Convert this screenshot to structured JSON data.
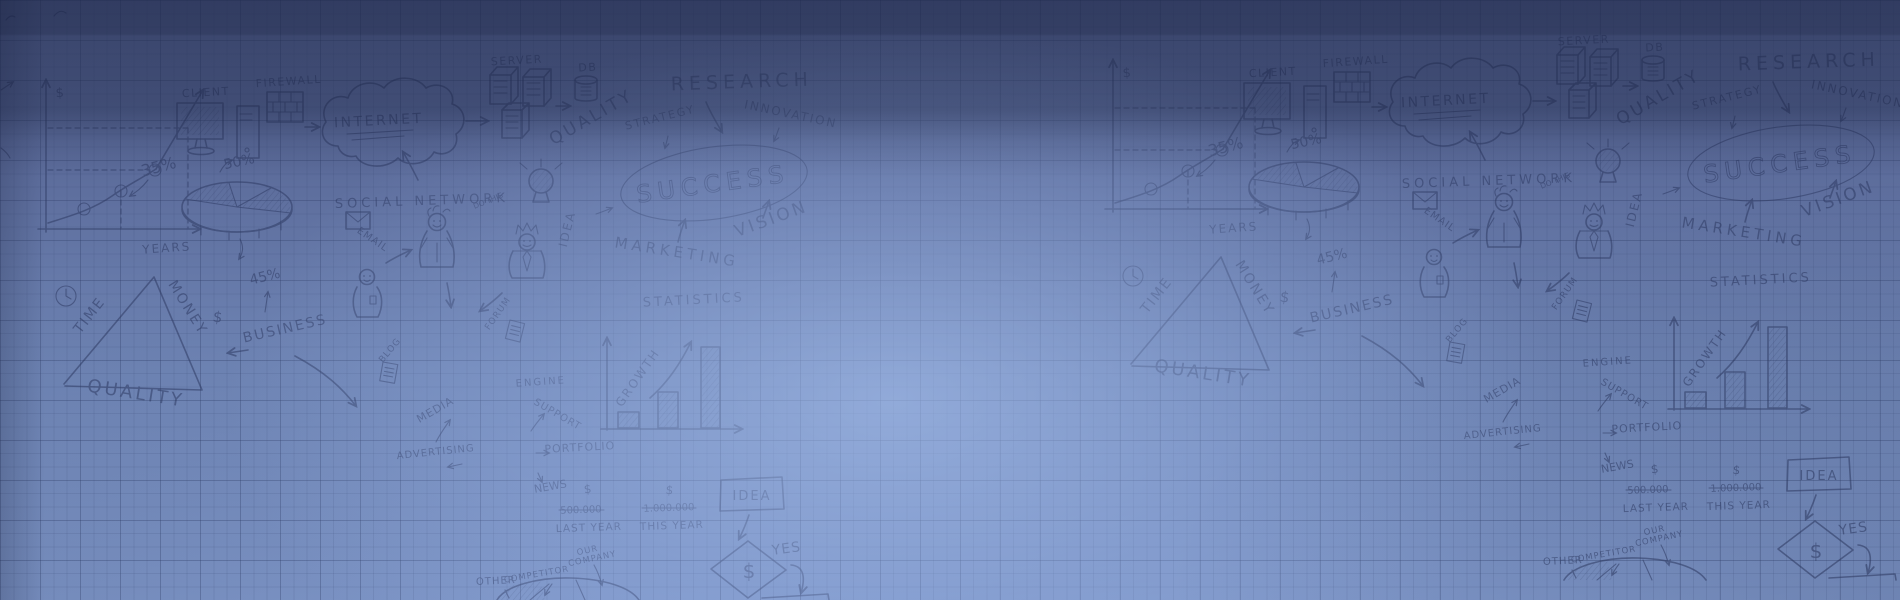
{
  "page": {
    "description": "Hand-drawn business strategy doodles sketched on blue graph paper; banner background with dark top band, central light glow, doodle tile repeated twice",
    "width": 1900,
    "height": 600
  },
  "background": {
    "base_top": "#4c5985",
    "base_bottom": "#7e96c8",
    "glow": "#a6c0ee",
    "top_band": "#0e1530",
    "grid_minor": "rgba(47,62,105,0.13)",
    "grid_major": "rgba(42,56,98,0.25)",
    "ink": "#2c3861"
  },
  "doodles": {
    "labels": {
      "client": "CLIENT",
      "firewall": "FIREWALL",
      "internet": "INTERNET",
      "server": "SERVER",
      "db": "DB",
      "quality_upper": "QUALITY",
      "research": "RESEARCH",
      "strategy": "STRATEGY",
      "innovation": "INNOVATION",
      "social_network": "SOCIAL NETWORK",
      "do_this": "DO THIS",
      "idea": "IDEA",
      "success": "SUCCESS",
      "vision": "VISION",
      "marketing": "MARKETING",
      "statistics": "STATISTICS",
      "growth": "GROWTH",
      "pct_35": "35%",
      "pct_50": "50%",
      "pct_45": "45%",
      "years": "YEARS",
      "dollar": "$",
      "email": "EMAIL",
      "time": "TIME",
      "money": "MONEY",
      "quality_lower": "QUALITY",
      "business": "BUSINESS",
      "forum": "FORUM",
      "blog": "BLOG",
      "media": "MEDIA",
      "advertising": "ADVERTISING",
      "engine": "ENGINE",
      "support": "SUPPORT",
      "portfolio": "PORTFOLIO",
      "news": "NEWS",
      "last_year_value": "500.000",
      "last_year": "LAST YEAR",
      "this_year_value": "1.000.000",
      "this_year": "THIS YEAR",
      "yes": "YES",
      "our": "OUR",
      "company": "COMPANY",
      "competitor": "COMPETITOR",
      "other": "OTHER"
    }
  }
}
